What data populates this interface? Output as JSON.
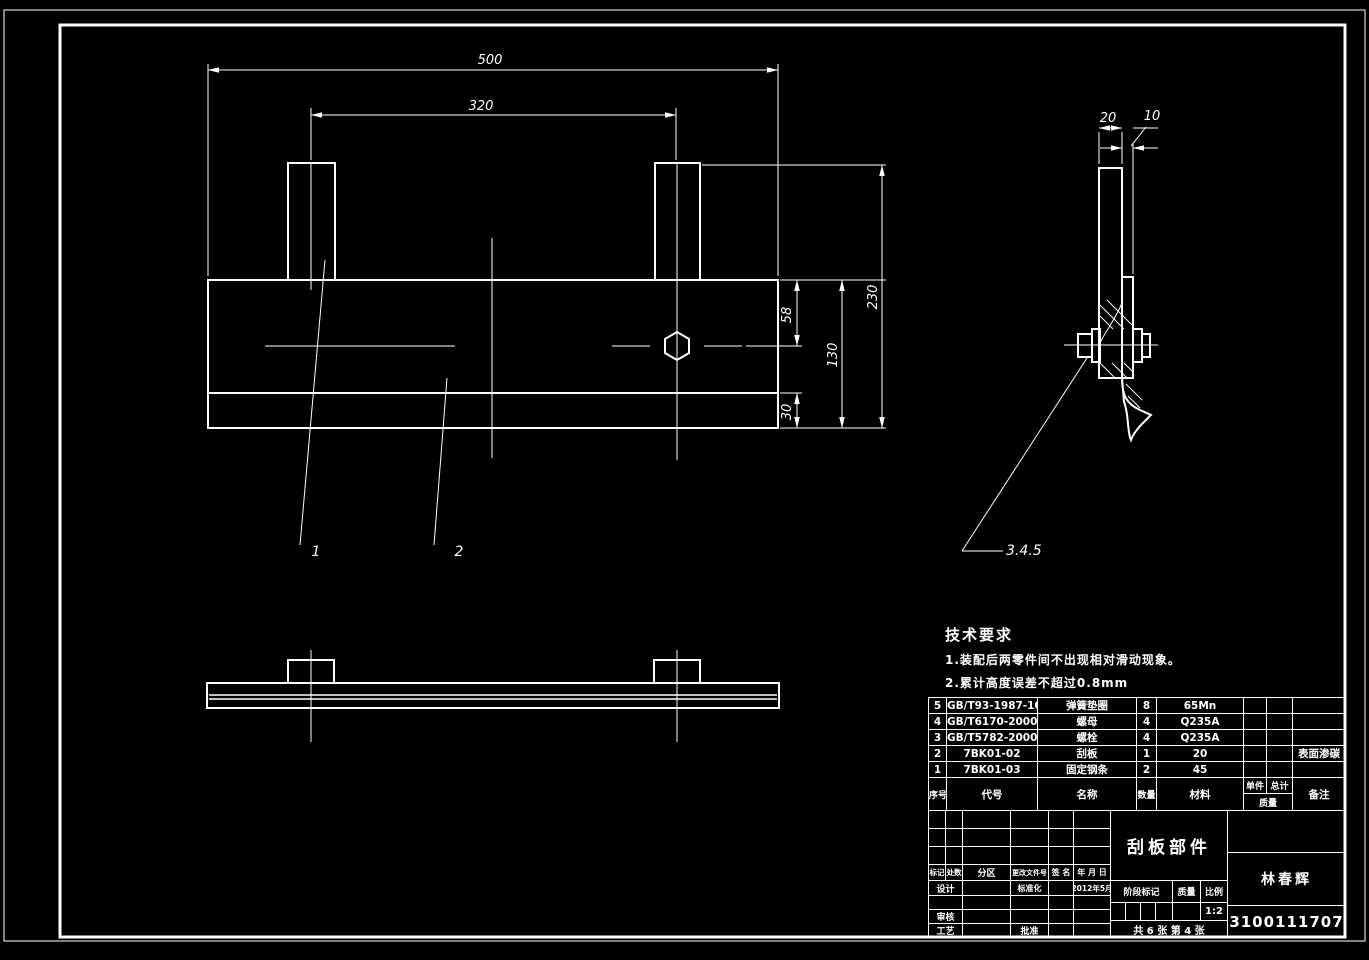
{
  "dims": {
    "front": {
      "w": "500",
      "inner": "320",
      "h": "230",
      "plate": "130",
      "top": "58",
      "bottom": "30"
    },
    "side": {
      "t1": "20",
      "t2": "10"
    },
    "balloons": {
      "one": "1",
      "two": "2",
      "grp": "3.4.5"
    }
  },
  "tech": {
    "heading": "技术要求",
    "line1": "1.装配后两零件间不出现相对滑动现象。",
    "line2": "2.累计高度误差不超过0.8mm"
  },
  "bom": {
    "headers": {
      "seq": "序号",
      "code": "代号",
      "name": "名称",
      "qty": "数量",
      "material": "材料",
      "unit": "单件",
      "total": "总计",
      "mass": "质量",
      "remark": "备注"
    },
    "rows": [
      {
        "seq": "5",
        "code": "GB/T93-1987-10",
        "name": "弹簧垫圈",
        "qty": "8",
        "material": "65Mn",
        "remark": ""
      },
      {
        "seq": "4",
        "code": "GB/T6170-2000-M10",
        "name": "螺母",
        "qty": "4",
        "material": "Q235A",
        "remark": ""
      },
      {
        "seq": "3",
        "code": "GB/T5782-2000-M10",
        "name": "螺栓",
        "qty": "4",
        "material": "Q235A",
        "remark": ""
      },
      {
        "seq": "2",
        "code": "7BK01-02",
        "name": "刮板",
        "qty": "1",
        "material": "20",
        "remark": "表面渗碳"
      },
      {
        "seq": "1",
        "code": "7BK01-03",
        "name": "固定钢条",
        "qty": "2",
        "material": "45",
        "remark": ""
      }
    ]
  },
  "tb": {
    "title": "刮板部件",
    "author": "林春辉",
    "number": "3100111707",
    "mark": "标记",
    "count": "处数",
    "zone": "分区",
    "doc": "更改文件号",
    "sign": "签 名",
    "ymd": "年 月 日",
    "design": "设计",
    "std": "标准化",
    "date": "2012年5月",
    "audit": "审核",
    "craft": "工艺",
    "approve": "批准",
    "stage": "阶段标记",
    "mass": "质量",
    "scale_lbl": "比例",
    "scale": "1:2",
    "sheet": "共 6 张  第 4 张"
  },
  "colors": {
    "background": "#000000",
    "line": "#ffffff"
  }
}
